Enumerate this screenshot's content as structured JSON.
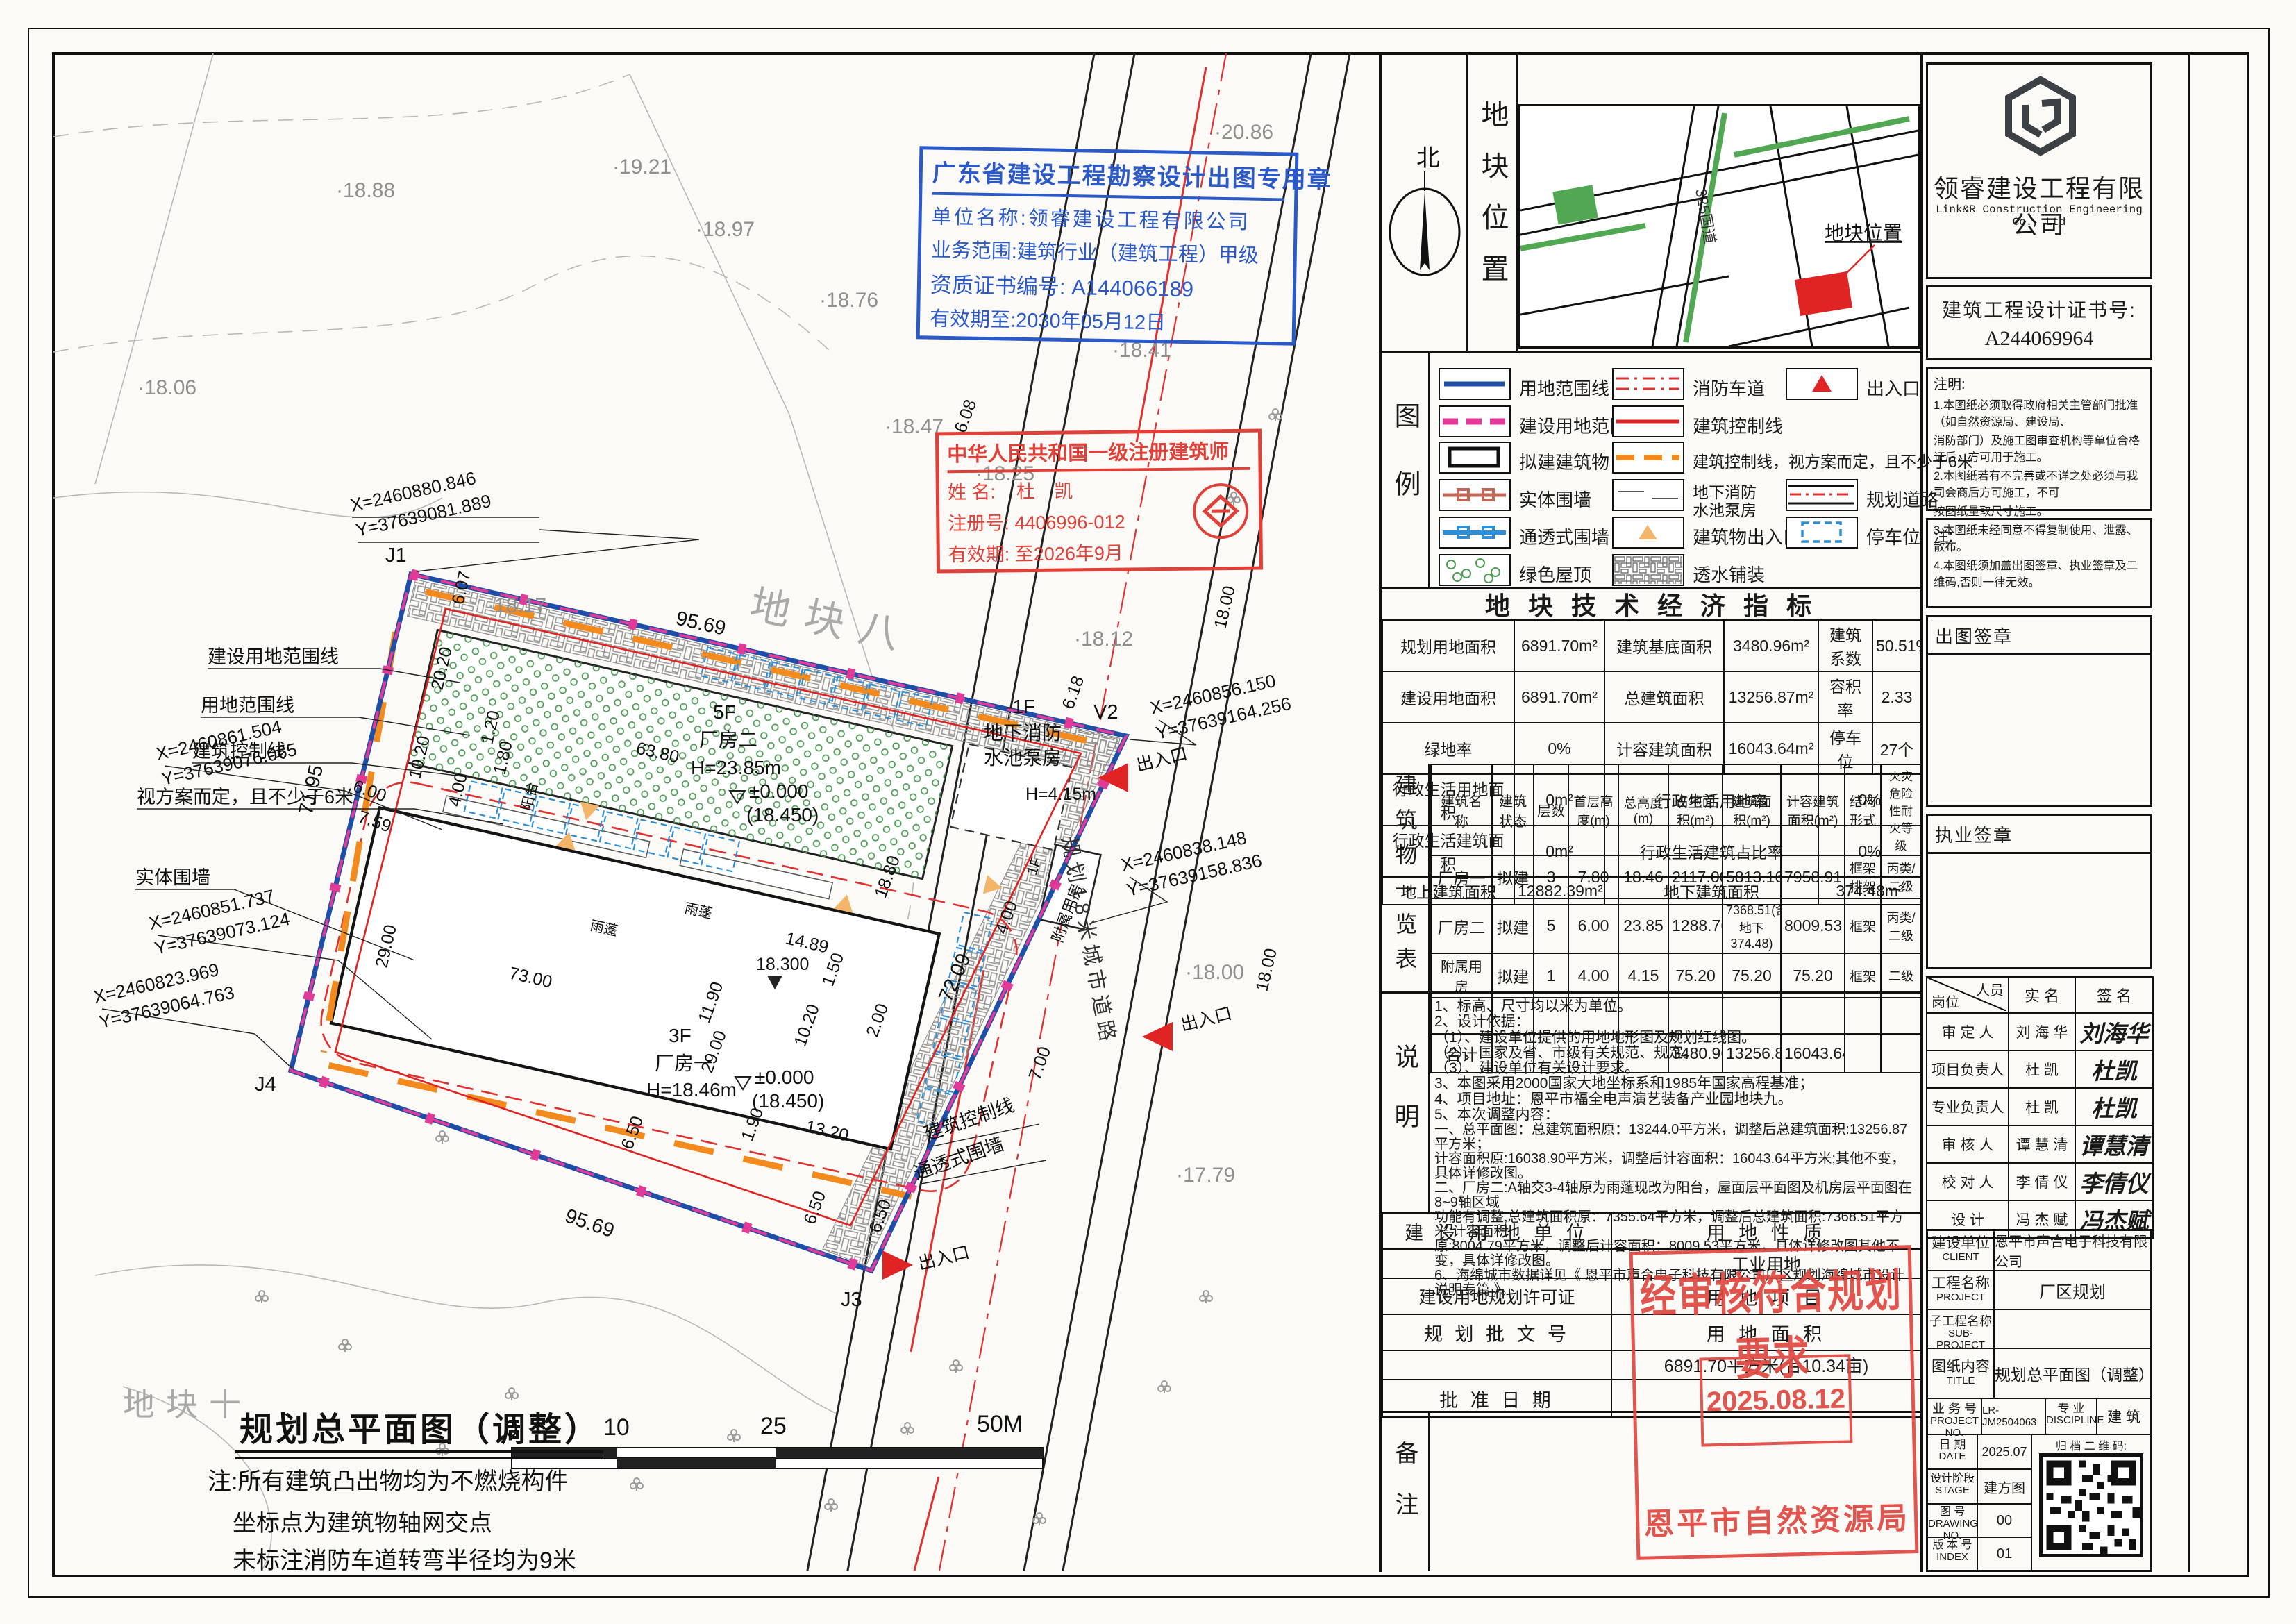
{
  "stamp_blue": {
    "title": "广东省建设工程勘察设计出图专用章",
    "line1": "单位名称:领睿建设工程有限公司",
    "line2": "业务范围:建筑行业（建筑工程）甲级",
    "line3": "资质证书编号: A144066189",
    "line4": "有效期至:2030年05月12日"
  },
  "stamp_red": {
    "title": "中华人民共和国一级注册建筑师",
    "name_label": "姓 名:",
    "name": "杜 凯",
    "reg_label": "注册号:",
    "reg": "4406996-012",
    "valid_label": "有效期:",
    "valid": "至2026年9月"
  },
  "stamp_approval": {
    "line": "经审核符合规划要求",
    "date": "2025.08.12",
    "agency": "恩平市自然资源局"
  },
  "location": {
    "north": "北",
    "panel_title": "地块位置",
    "plot_label": "地块位置",
    "road": "325国道"
  },
  "legend": {
    "panel_title": "图例",
    "items": {
      "i0": "用地范围线",
      "i1": "建设用地范围线",
      "i2": "拟建建筑物",
      "i3": "实体围墙",
      "i4": "通透式围墙",
      "i5": "绿色屋顶",
      "i6": "消防车道",
      "i7": "建筑控制线",
      "i8": "建筑控制线，视方案而定，且不少于6米",
      "i9a": "地下消防",
      "i9b": "水池泵房",
      "i10": "建筑物出入口",
      "i11": "透水铺装",
      "i12": "出入口",
      "i13": "规划道路",
      "i14": "停车位"
    }
  },
  "indicators": {
    "title": "地 块 技 术 经 济 指 标",
    "r0": [
      "规划用地面积",
      "6891.70m²",
      "建筑基底面积",
      "3480.96m²",
      "建筑系数",
      "50.51%"
    ],
    "r1": [
      "建设用地面积",
      "6891.70m²",
      "总建筑面积",
      "13256.87m²",
      "容积率",
      "2.33"
    ],
    "r2": [
      "绿地率",
      "0%",
      "计容建筑面积",
      "16043.64m²",
      "停车位",
      "27个"
    ],
    "r3": [
      "行政生活用地面积",
      "0m²",
      "行政生活用地率",
      "0%"
    ],
    "r4": [
      "行政生活建筑面积",
      "0m²",
      "行政生活建筑占比率",
      "0%"
    ],
    "r5": [
      "地上建筑面积",
      "12882.39m²",
      "地下建筑面积",
      "374.48m²"
    ]
  },
  "buildings": {
    "panel_title": "建筑物一览表",
    "headers": [
      "建筑名称",
      "建筑状态",
      "层数",
      "首层高度(m)",
      "总高度(m)",
      "占地面积(m²)",
      "建筑面积(m²)",
      "计容建筑面积(m²)",
      "结构形式",
      "火灾危险性耐火等级"
    ],
    "rows": [
      [
        "厂房一",
        "拟建",
        "3",
        "7.80",
        "18.46",
        "2117.00",
        "5813.16",
        "7958.91",
        "框架排架",
        "丙类/二级"
      ],
      [
        "厂房二",
        "拟建",
        "5",
        "6.00",
        "23.85",
        "1288.76",
        "7368.51(含地下374.48)",
        "8009.53",
        "框架",
        "丙类/二级"
      ],
      [
        "附属用房",
        "拟建",
        "1",
        "4.00",
        "4.15",
        "75.20",
        "75.20",
        "75.20",
        "框架",
        "二级"
      ],
      [
        "",
        "",
        "",
        "",
        "",
        "",
        "",
        "",
        "",
        ""
      ],
      [
        "合计",
        "",
        "",
        "",
        "",
        "3480.96",
        "13256.87",
        "16043.64",
        "",
        ""
      ]
    ]
  },
  "notes_panel": {
    "title": "说明",
    "lines": [
      "1、标高、尺寸均以米为单位。",
      "2、设计依据：",
      "（1）、建设单位提供的用地地形图及规划红线图。",
      "（2）、国家及省、市级有关规范、规定。",
      "（3）、建设单位有关设计要求。",
      "3、本图采用2000国家大地坐标系和1985年国家高程基准；",
      "4、项目地址：恩平市福全电声演艺装备产业园地块九。",
      "5、本次调整内容：",
      "一、总平面图：总建筑面积原：13244.0平方米，调整后总建筑面积:13256.87平方米；",
      "计容面积原:16038.90平方米，调整后计容面积：16043.64平方米;其他不变，具体详修改图。",
      "二、厂房二:A轴交3-4轴原为雨蓬现改为阳台，屋面层平面图及机房层平面图在8~9轴区域",
      "功能有调整,总建筑面积原：7355.64平方米，调整后总建筑面积:7368.51平方米;计容面积",
      "原:8004.79平方米，调整后计容面积：8009.53平方米，具体详修改图其他不变，具体详修改图。",
      "6、海绵城市数据详见《 恩平市声合电子科技有限公司厂区规划海绵城市设计说明专篇 》。"
    ]
  },
  "landuse": {
    "r1l": "建 设 用 地 单 位",
    "r1r": "用 地 性 质",
    "r2r": "工业用地",
    "r3l": "建设用地规划许可证",
    "r3r": "用 地 项 目",
    "r4l": "规 划 批 文 号",
    "r4r": "用 地 面 积",
    "r5r": "6891.70平方米(合10.34亩)",
    "r6l": "批 准 日 期",
    "remark": "备注"
  },
  "titleblock": {
    "company": "领睿建设工程有限公司",
    "company_en": "Link&R Construction Engineering Co., Ltd",
    "cert_label": "建筑工程设计证书号:",
    "cert_no": "A244069964",
    "notes_title": "注明:",
    "notes": [
      "1.本图纸必须取得政府相关主管部门批准（如自然资源局、建设局、",
      "消防部门）及施工图审查机构等单位合格证后，方可用于施工。",
      "2.本图纸若有不完善或不详之处必须与我司会商后方可施工，不可",
      "按图纸量取尺寸施工。",
      "3.本图纸未经同意不得复制使用、泄露、散布。",
      "4.本图纸须加盖出图签章、执业签章及二维码,否则一律无效。"
    ],
    "note2": "注:",
    "chutu": "出图签章",
    "zhiye": "执业签章",
    "sign": {
      "h0": "岗位",
      "h0b": "人员",
      "h1": "实  名",
      "h2": "签  名",
      "rows": [
        [
          "审 定 人",
          "刘 海 华",
          "刘海华"
        ],
        [
          "项目负责人",
          "杜   凯",
          "杜凯"
        ],
        [
          "专业负责人",
          "杜   凯",
          "杜凯"
        ],
        [
          "审 核 人",
          "谭 慧 清",
          "谭慧清"
        ],
        [
          "校 对 人",
          "李 倩 仪",
          "李倩仪"
        ],
        [
          "设   计",
          "冯 杰 赋",
          "冯杰赋"
        ]
      ]
    },
    "client_l": "建设单位",
    "client_en": "CLIENT",
    "client": "恩平市声合电子科技有限公司",
    "proj_l": "工程名称",
    "proj_en": "PROJECT",
    "proj": "厂区规划",
    "sub_l": "子工程名称",
    "sub_en": "SUB-PROJECT",
    "sub": "",
    "title_l": "图纸内容",
    "title_en": "TITLE",
    "title": "规划总平面图（调整）",
    "biz_l": "业 务 号",
    "biz_en": "PROJECT NO.",
    "biz": "LR-JM2504063",
    "disc_l": "专  业",
    "disc_en": "DISCIPLINE",
    "disc": "建  筑",
    "date_l": "日  期",
    "date_en": "DATE",
    "date": "2025.07",
    "qr_l": "归 档 二 维 码:",
    "stage_l": "设计阶段",
    "stage_en": "STAGE",
    "stage": "建方图",
    "dwg_l": "图  号",
    "dwg_en": "DRAWING NO.",
    "dwg": "00",
    "idx_l": "版 本 号",
    "idx_en": "INDEX",
    "idx": "01"
  },
  "plan": {
    "title": "规划总平面图（调整）",
    "notes": [
      "注:所有建筑凸出物均为不燃烧构件",
      "坐标点为建筑物轴网交点",
      "未标注消防车道转弯半径均为9米"
    ],
    "scale": [
      "0",
      "10",
      "25",
      "50M"
    ],
    "road_label": "规划18米城市道路",
    "area8": "地块八",
    "area10": "地块十",
    "gate": "出入口",
    "left_labels": [
      "建设用地范围线",
      "用地范围线",
      "建筑控制线",
      "视方案而定，且不少于6米",
      "实体围墙"
    ],
    "right_labels": [
      "建筑控制线",
      "通透式围墙"
    ],
    "coords": [
      {
        "x": "X=2460880.846",
        "y": "Y=37639081.889"
      },
      {
        "x": "X=2460861.504",
        "y": "Y=37639076.065"
      },
      {
        "x": "X=2460851.737",
        "y": "Y=37639073.124"
      },
      {
        "x": "X=2460823.969",
        "y": "Y=37639064.763"
      },
      {
        "x": "X=2460856.150",
        "y": "Y=37639164.256"
      },
      {
        "x": "X=2460838.148",
        "y": "Y=37639158.836"
      }
    ],
    "pts": [
      "J1",
      "J4",
      "J3",
      "V2"
    ],
    "bld1": [
      "3F",
      "厂房一",
      "H=18.46m"
    ],
    "bld2": [
      "5F",
      "厂房二",
      "H=23.85m"
    ],
    "pump": [
      "-1F",
      "地下消防",
      "水池泵房"
    ],
    "aux": [
      "1F",
      "附属用房"
    ],
    "level": "±0.000",
    "level2": "(18.450)",
    "canopy": "雨蓬",
    "balcony": "阳台",
    "dims": [
      "95.69",
      "95.69",
      "71.95",
      "72.09",
      "63.80",
      "73.00",
      "29.00",
      "29.00",
      "20.20",
      "6.07",
      "6.08",
      "6.50",
      "6.50",
      "6.50",
      "6.00",
      "7.59",
      "18.00",
      "18.00",
      "14.89",
      "18.300",
      "1.50",
      "10.20",
      "11.90",
      "2.00",
      "13.20",
      "1.90",
      "18.80",
      "4.00",
      "7.00",
      "1.80",
      "1.20",
      "4.00",
      "6.18",
      "10.20",
      "H=4.15m"
    ],
    "contours": [
      "·20.86",
      "·18.88",
      "·19.21",
      "·18.97",
      "·18.76",
      "·18.47",
      "·18.06",
      "·18.41",
      "·18.17",
      "·18.25",
      "·18.12",
      "·18.00",
      "·17.79"
    ]
  }
}
